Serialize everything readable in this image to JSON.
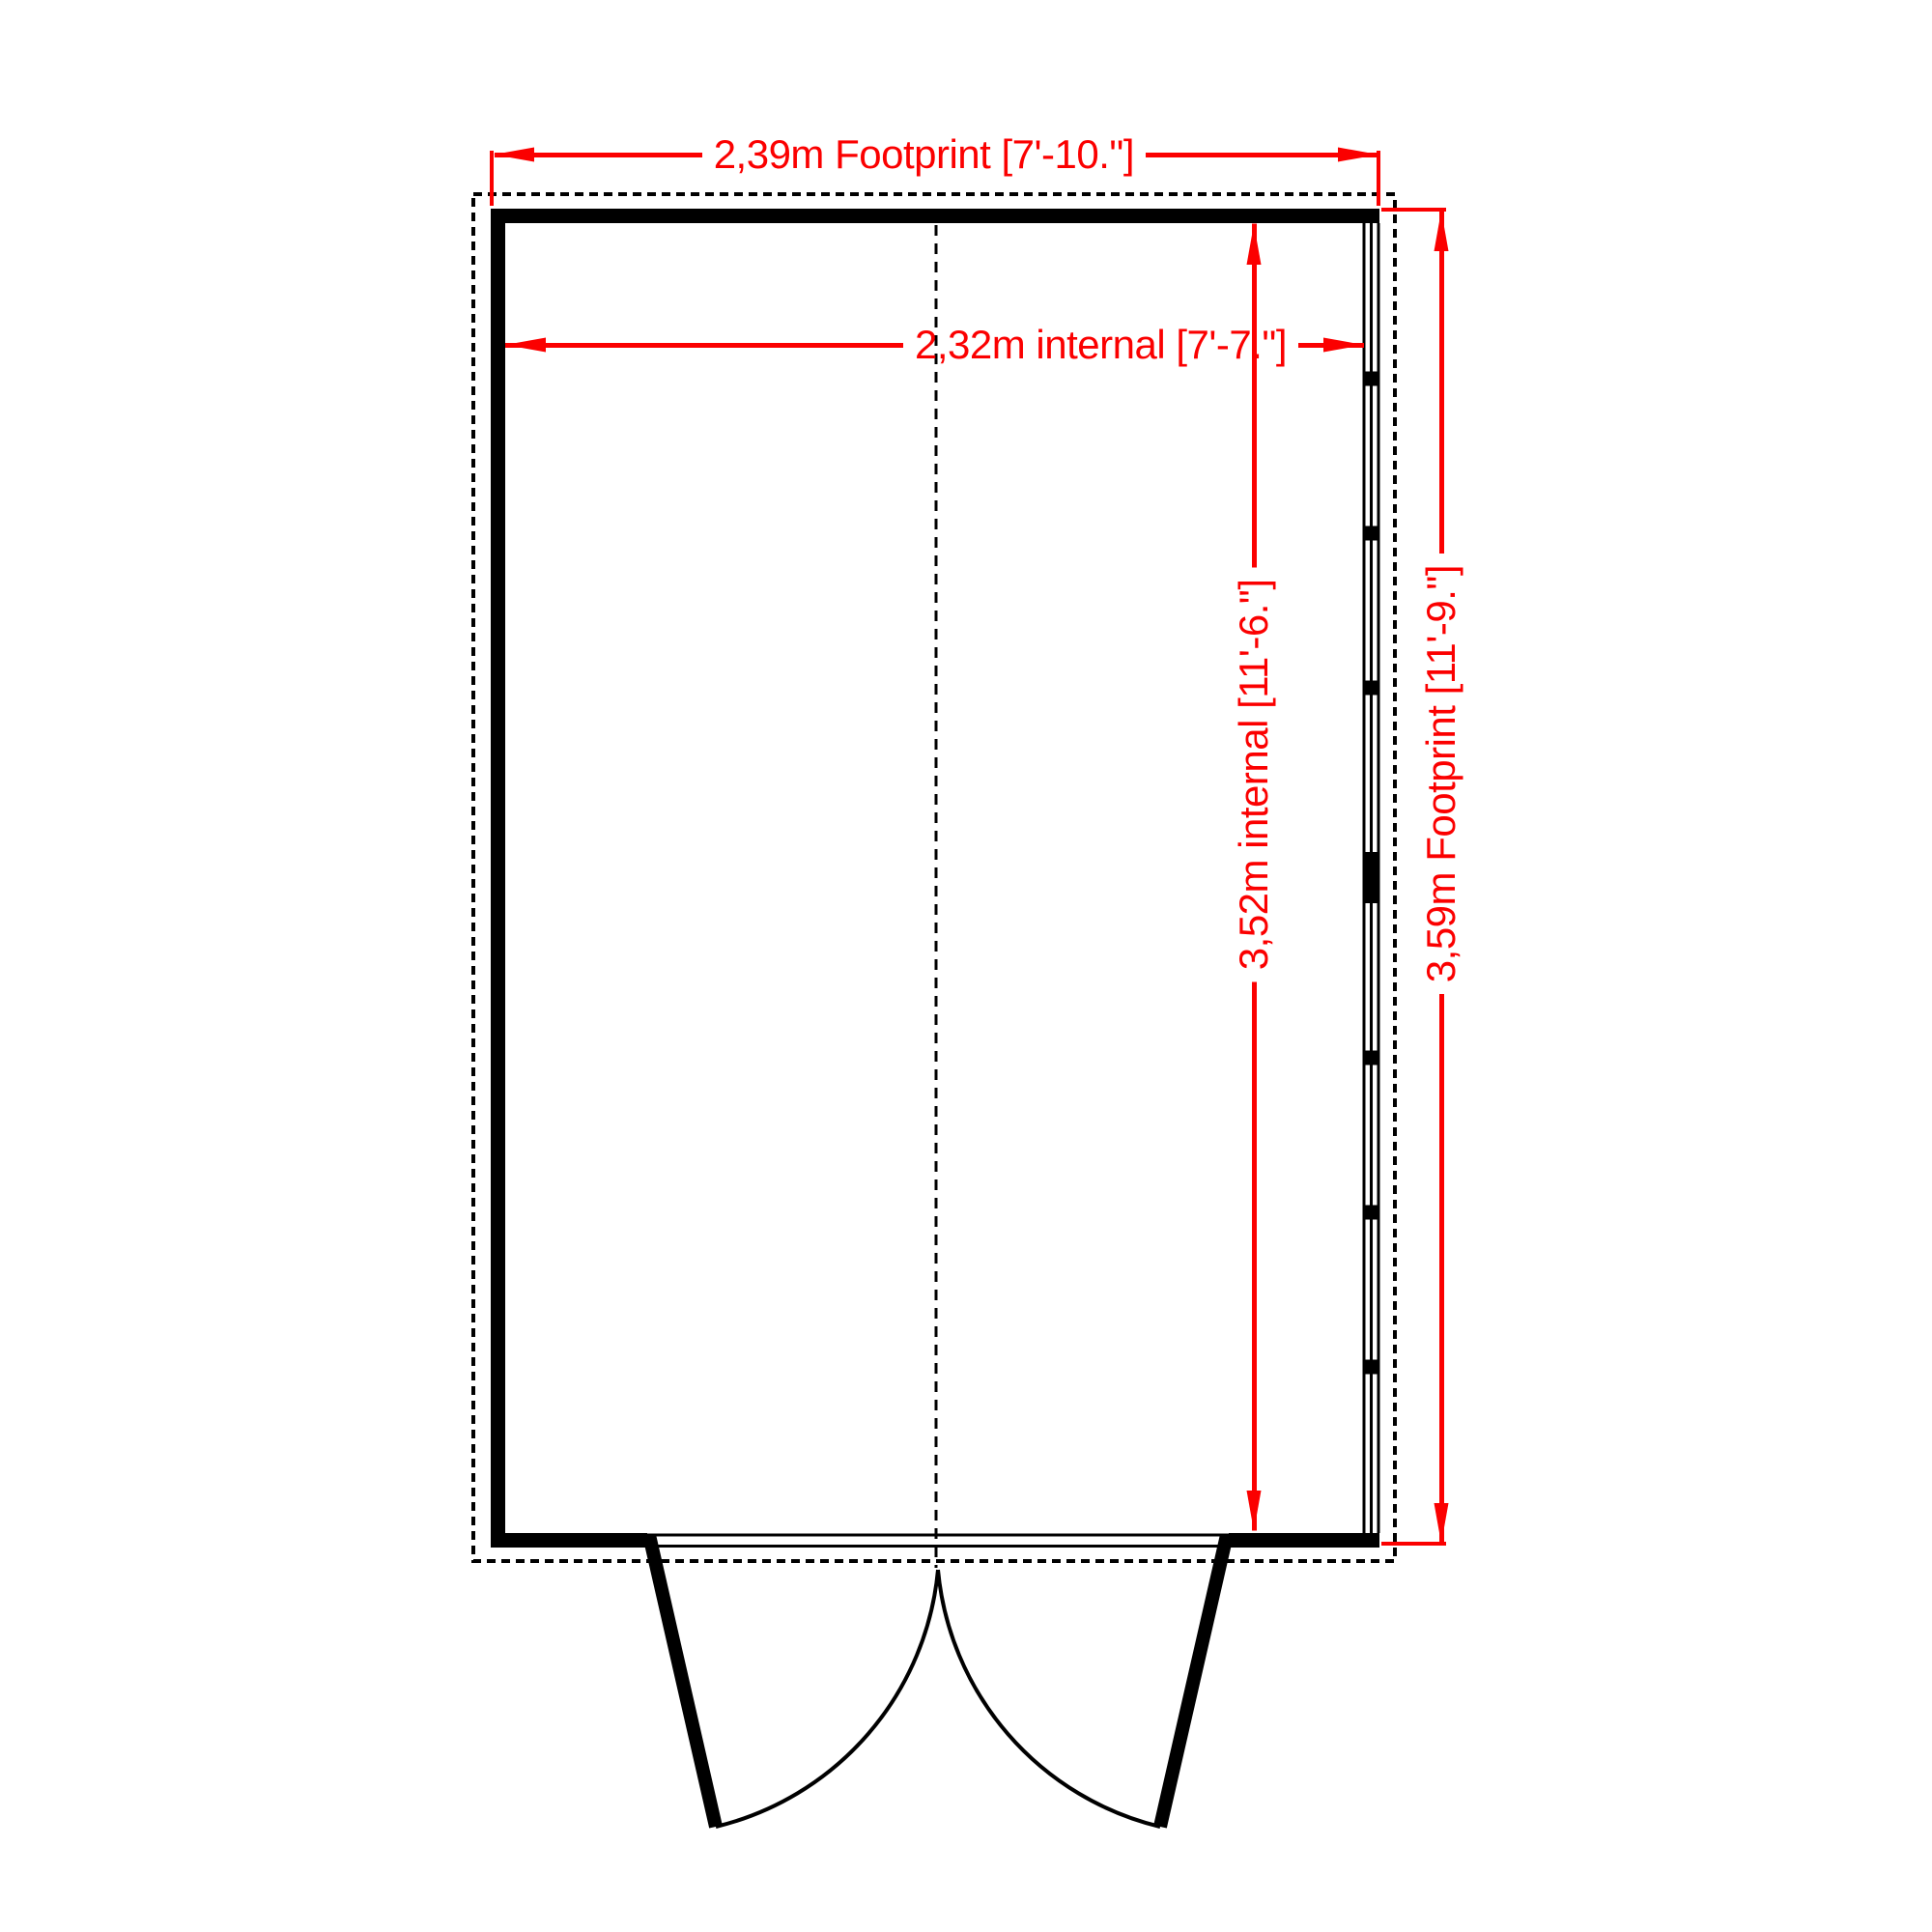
{
  "diagram": {
    "type": "floor-plan",
    "labels": {
      "footprint_width": "2,39m Footprint [7'-10.\"]",
      "internal_width": "2,32m internal [7'-7.\"]",
      "internal_depth": "3,52m internal [11'-6.\"]",
      "footprint_depth": "3,59m Footprint [11'-9.\"]"
    },
    "colors": {
      "dimension": "#fb0000",
      "wall": "#000000",
      "background": "#ffffff"
    },
    "features": {
      "door": "double outward-opening doors, bottom center",
      "window_wall": "glazed right wall with mullions",
      "footprint_outline": "dashed rectangle",
      "center_line": "dashed vertical center line"
    }
  }
}
